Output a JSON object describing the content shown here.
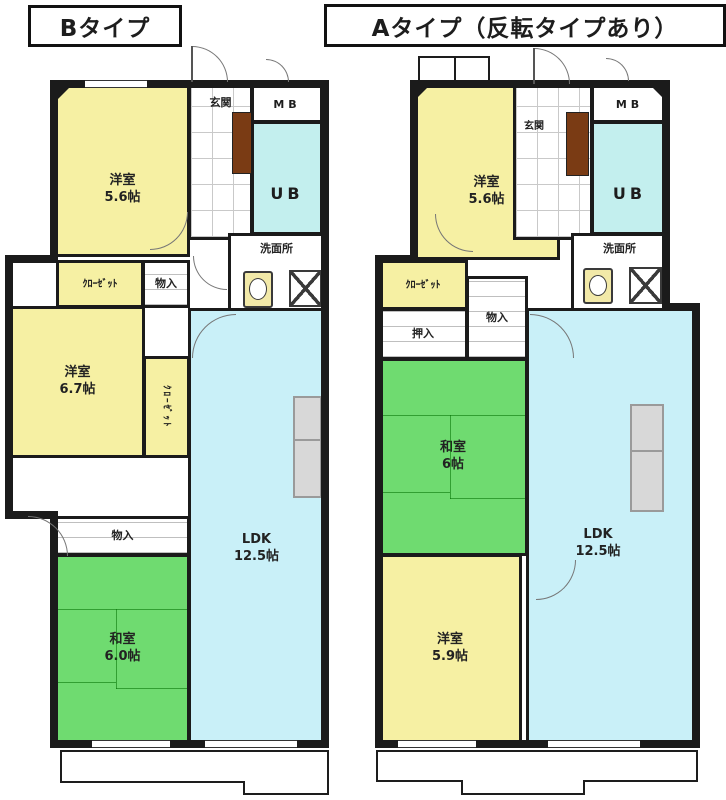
{
  "plan_b": {
    "title": "Bタイプ",
    "rooms": {
      "bedroom1": {
        "name": "洋室",
        "size": "5.6帖"
      },
      "entrance": {
        "name": "玄関"
      },
      "meter_box": {
        "name": "MB"
      },
      "unit_bath": {
        "name": "UB"
      },
      "washroom": {
        "name": "洗面所"
      },
      "closet1": {
        "name": "ｸﾛｰｾﾞｯﾄ"
      },
      "storage1": {
        "name": "物入"
      },
      "bedroom2": {
        "name": "洋室",
        "size": "6.7帖"
      },
      "closet2": {
        "name": "ｸﾛｰｾﾞｯﾄ"
      },
      "ldk": {
        "name": "LDK",
        "size": "12.5帖"
      },
      "storage2": {
        "name": "物入"
      },
      "washitsu": {
        "name": "和室",
        "size": "6.0帖"
      }
    }
  },
  "plan_a": {
    "title": "Aタイプ（反転タイプあり）",
    "rooms": {
      "bedroom1": {
        "name": "洋室",
        "size": "5.6帖"
      },
      "entrance": {
        "name": "玄関"
      },
      "meter_box": {
        "name": "MB"
      },
      "unit_bath": {
        "name": "UB"
      },
      "washroom": {
        "name": "洗面所"
      },
      "closet1": {
        "name": "ｸﾛｰｾﾞｯﾄ"
      },
      "oshiire": {
        "name": "押入"
      },
      "storage1": {
        "name": "物入"
      },
      "washitsu": {
        "name": "和室",
        "size": "6帖"
      },
      "bedroom2": {
        "name": "洋室",
        "size": "5.9帖"
      },
      "ldk": {
        "name": "LDK",
        "size": "12.5帖"
      }
    }
  },
  "colors": {
    "wall": "#1b1b1b",
    "western_room": "#f6f0a3",
    "tatami_room": "#6fdb70",
    "ldk": "#c9f0f8",
    "unit_bath": "#c3efee",
    "wc_floor": "#efe9a8",
    "cabinet": "#7a3b14",
    "counter": "#d8d8d8"
  }
}
